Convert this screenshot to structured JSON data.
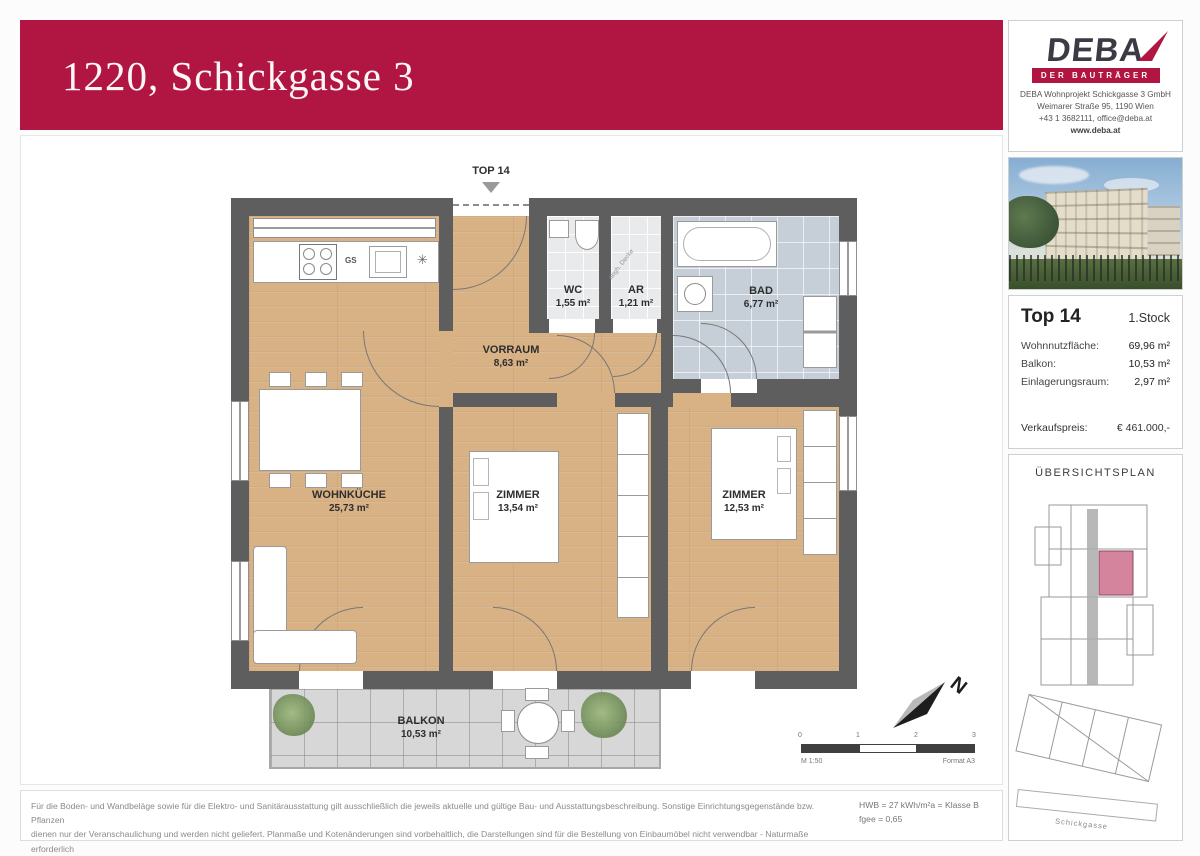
{
  "title": "1220, Schickgasse 3",
  "brand": {
    "logo": "DEBA",
    "tagline": "DER BAUTRÄGER",
    "company": "DEBA Wohnprojekt Schickgasse 3 GmbH",
    "address": "Weimarer Straße 95, 1190 Wien",
    "contact": "+43 1 3682111, office@deba.at",
    "website": "www.deba.at"
  },
  "unit": {
    "name": "Top 14",
    "floor": "1.Stock",
    "area_label": "Wohnnutzfläche:",
    "area_value": "69,96 m²",
    "balcony_label": "Balkon:",
    "balcony_value": "10,53 m²",
    "storage_label": "Einlagerungsraum:",
    "storage_value": "2,97 m²",
    "price_label": "Verkaufspreis:",
    "price_value": "€ 461.000,-"
  },
  "overview": {
    "title": "ÜBERSICHTSPLAN",
    "street": "Schickgasse"
  },
  "plan": {
    "entrance": "TOP 14",
    "rooms": [
      {
        "name": "WC",
        "area": "1,55 m²"
      },
      {
        "name": "AR",
        "area": "1,21 m²"
      },
      {
        "name": "BAD",
        "area": "6,77 m²"
      },
      {
        "name": "VORRAUM",
        "area": "8,63 m²"
      },
      {
        "name": "WOHNKÜCHE",
        "area": "25,73 m²"
      },
      {
        "name": "ZIMMER",
        "area": "13,54 m²"
      },
      {
        "name": "ZIMMER",
        "area": "12,53 m²"
      },
      {
        "name": "BALKON",
        "area": "10,53 m²"
      }
    ],
    "notes": {
      "ceiling": "abgh. Decke",
      "dishwasher": "GS"
    },
    "north": "N",
    "scale": {
      "ticks": [
        "0",
        "1",
        "2",
        "3"
      ],
      "label": "M 1:50",
      "format": "Format A3"
    }
  },
  "footer": {
    "line1": "Für die Boden- und Wandbeläge sowie für die Elektro- und Sanitärausstattung gilt ausschließlich die jeweils aktuelle und gültige Bau- und Ausstattungsbeschreibung. Sonstige Einrichtungsgegenstände bzw. Pflanzen",
    "line2": "dienen nur der Veranschaulichung und werden nicht geliefert. Planmaße und Kotenänderungen sind vorbehaltlich, die Darstellungen sind für die Bestellung von Einbaumöbel nicht verwendbar - Naturmaße erforderlich",
    "energy1": "HWB = 27 kWh/m²a = Klasse B",
    "energy2": "fgee = 0,65"
  },
  "colors": {
    "brand_red": "#B11541",
    "wall": "#5E5E5E",
    "wood": "#D9B588",
    "bath_tile": "#C6CFD8",
    "balcony_tile": "#D7D7D7",
    "highlight_pink": "#D4849C"
  }
}
